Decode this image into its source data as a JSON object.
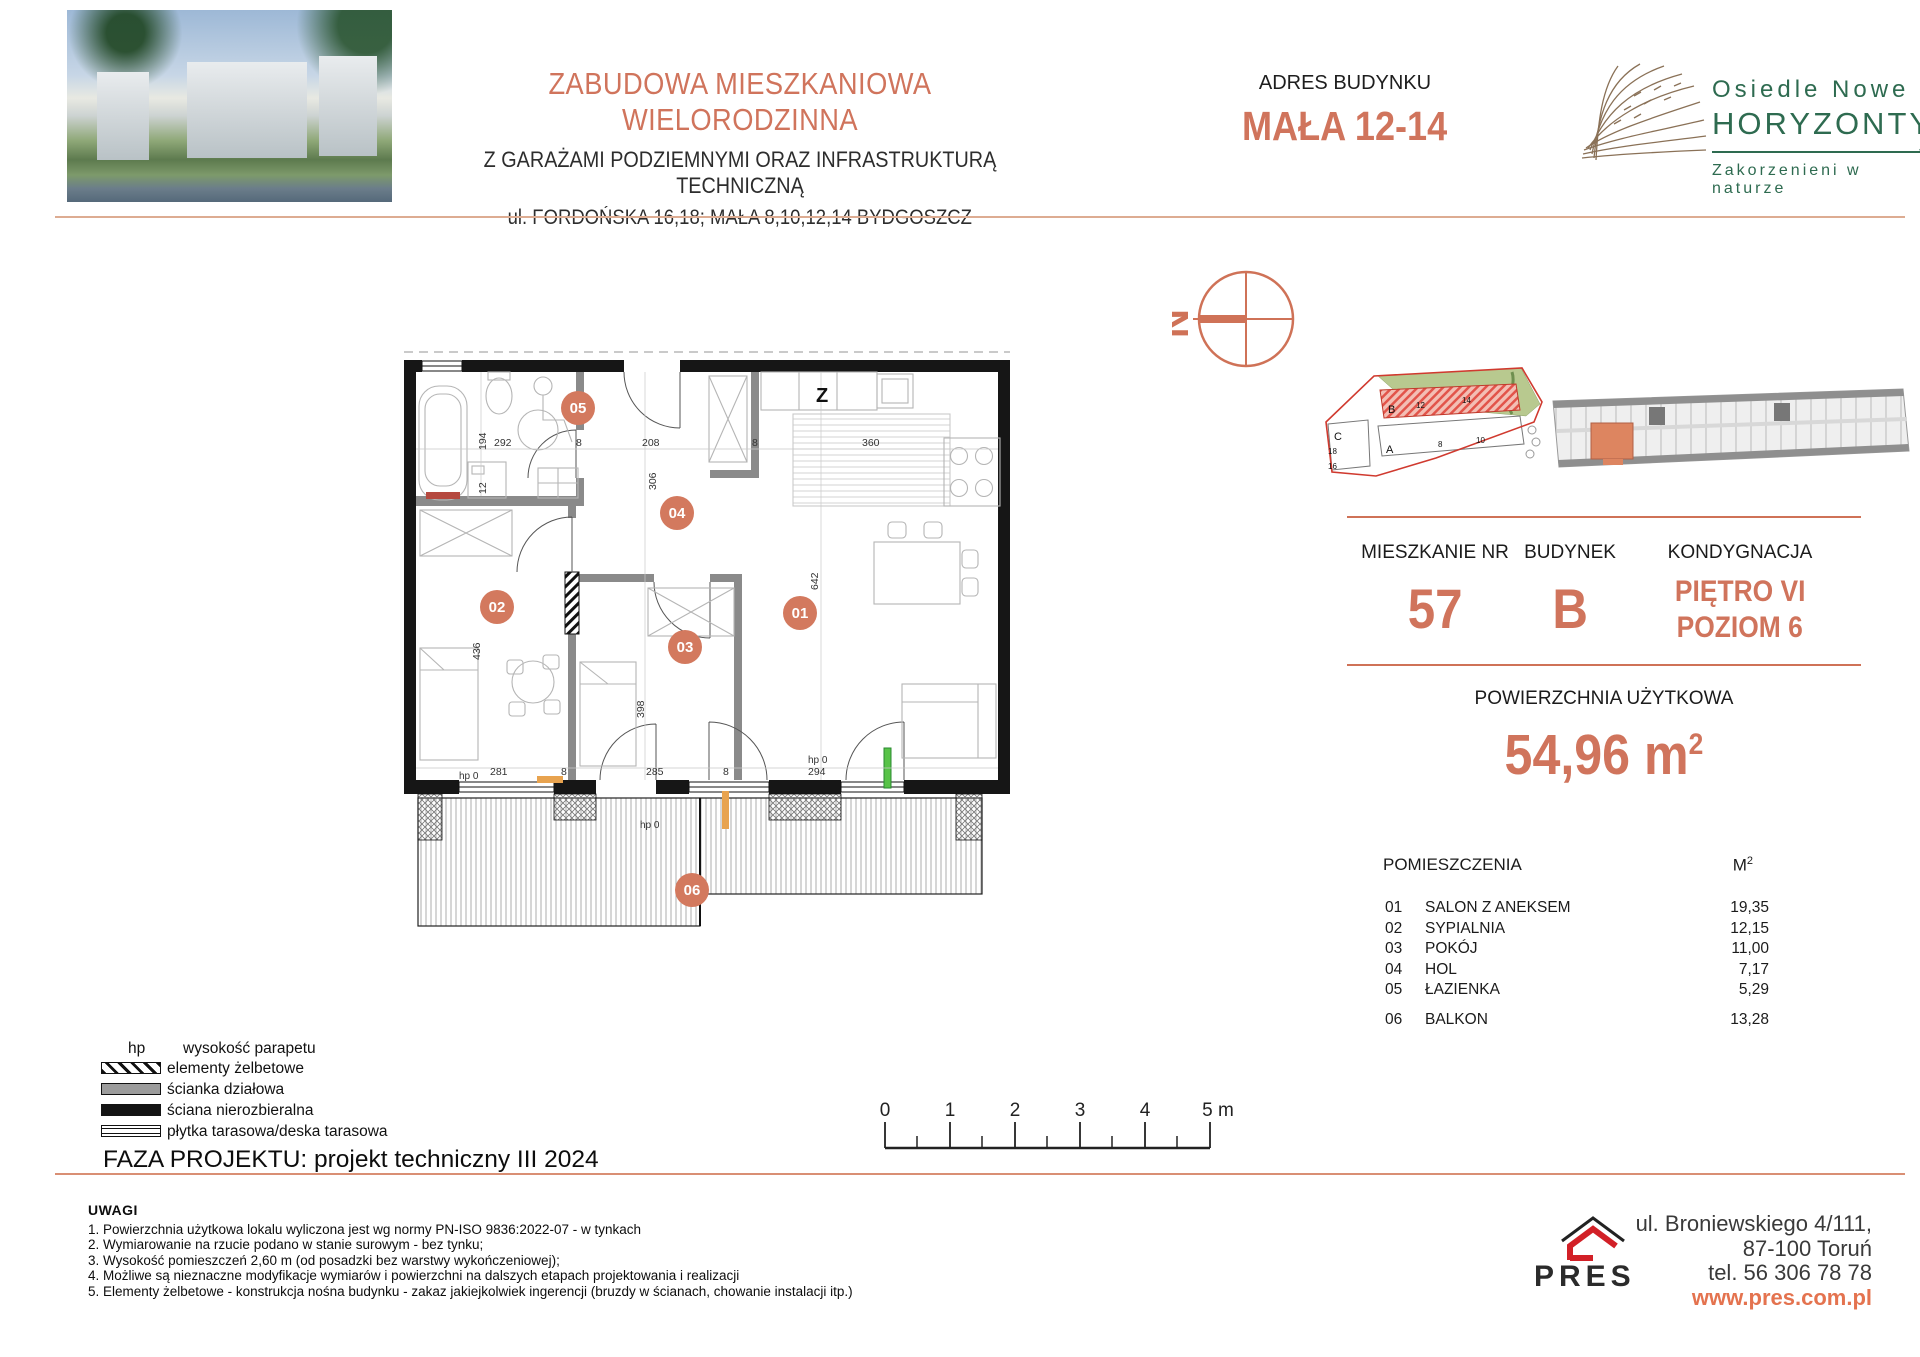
{
  "header": {
    "title": "ZABUDOWA MIESZKANIOWA WIELORODZINNA",
    "subtitle1": "Z GARAŻAMI PODZIEMNYMI ORAZ INFRASTRUKTURĄ TECHNICZNĄ",
    "subtitle2": "ul. FORDOŃSKA 16,18; MAŁA 8,10,12,14 BYDGOSZCZ",
    "address_label": "ADRES BUDYNKU",
    "address_value": "MAŁA 12-14",
    "logo": {
      "line1": "Osiedle Nowe",
      "line2": "HORYZONTY",
      "arrow": "‹‹",
      "tagline": "Zakorzenieni w naturze"
    }
  },
  "compass": {
    "letter": "N"
  },
  "siteplan": {
    "labels": [
      "C",
      "18",
      "16",
      "B",
      "12",
      "14",
      "A",
      "8",
      "10"
    ]
  },
  "info": {
    "col1_label": "MIESZKANIE NR",
    "col1_value": "57",
    "col2_label": "BUDYNEK",
    "col2_value": "B",
    "col3_label": "KONDYGNACJA",
    "col3_value_line1": "PIĘTRO VI",
    "col3_value_line2": "POZIOM 6",
    "area_label": "POWIERZCHNIA UŻYTKOWA",
    "area_value": "54,96",
    "area_unit": "m",
    "area_sup": "2"
  },
  "rooms": {
    "header_name": "POMIESZCZENIA",
    "header_unit": "M",
    "header_unit_sup": "2",
    "items": [
      {
        "id": "01",
        "name": "SALON Z ANEKSEM",
        "area": "19,35"
      },
      {
        "id": "02",
        "name": "SYPIALNIA",
        "area": "12,15"
      },
      {
        "id": "03",
        "name": "POKÓJ",
        "area": "11,00"
      },
      {
        "id": "04",
        "name": "HOL",
        "area": "7,17"
      },
      {
        "id": "05",
        "name": "ŁAZIENKA",
        "area": "5,29"
      },
      {
        "id": "06",
        "name": "BALKON",
        "area": "13,28"
      }
    ]
  },
  "plan": {
    "kitchen_label": "Z",
    "badges": [
      {
        "label": "05"
      },
      {
        "label": "04"
      },
      {
        "label": "02"
      },
      {
        "label": "03"
      },
      {
        "label": "01"
      },
      {
        "label": "06"
      }
    ],
    "dims": [
      {
        "t": "194"
      },
      {
        "t": "292"
      },
      {
        "t": "12"
      },
      {
        "t": "8"
      },
      {
        "t": "208"
      },
      {
        "t": "306"
      },
      {
        "t": "8"
      },
      {
        "t": "360"
      },
      {
        "t": "642"
      },
      {
        "t": "436"
      },
      {
        "t": "398"
      },
      {
        "t": "281"
      },
      {
        "t": "8"
      },
      {
        "t": "285"
      },
      {
        "t": "8"
      },
      {
        "t": "294"
      },
      {
        "t": "hp 0"
      },
      {
        "t": "hp 0"
      },
      {
        "t": "hp 0"
      }
    ]
  },
  "legend": {
    "hp_abbr": "hp",
    "hp_label": "wysokość parapetu",
    "items": [
      "elementy żelbetowe",
      "ścianka działowa",
      "ściana nierozbieralna",
      "płytka tarasowa/deska tarasowa"
    ],
    "phase": "FAZA PROJEKTU: projekt techniczny III 2024"
  },
  "scalebar": {
    "labels": [
      "0",
      "1",
      "2",
      "3",
      "4",
      "5 m"
    ]
  },
  "notes": {
    "title": "UWAGI",
    "items": [
      "1. Powierzchnia użytkowa lokalu wyliczona jest wg normy PN-ISO 9836:2022-07 - w tynkach",
      "2. Wymiarowanie na rzucie podano w stanie surowym - bez tynku;",
      "3. Wysokość pomieszczeń 2,60 m (od posadzki bez warstwy wykończeniowej);",
      "4. Możliwe są nieznaczne modyfikacje wymiarów i powierzchni na dalszych etapach projektowania i realizacji",
      "5. Elementy żelbetowe - konstrukcja nośna budynku - zakaz jakiejkolwiek ingerencji (bruzdy w ścianach, chowanie instalacji itp.)"
    ]
  },
  "footer": {
    "brand": "PRES",
    "address_line1": "ul. Broniewskiego  4/111,",
    "address_line2": "87-100 Toruń",
    "address_line3": "tel. 56 306 78 78",
    "website": "www.pres.com.pl"
  },
  "colors": {
    "accent_salmon": "#d0745c",
    "logo_green": "#2e6b50",
    "pres_red": "#d22027",
    "wall_black": "#161616",
    "partition_gray": "#8a8a8a"
  }
}
